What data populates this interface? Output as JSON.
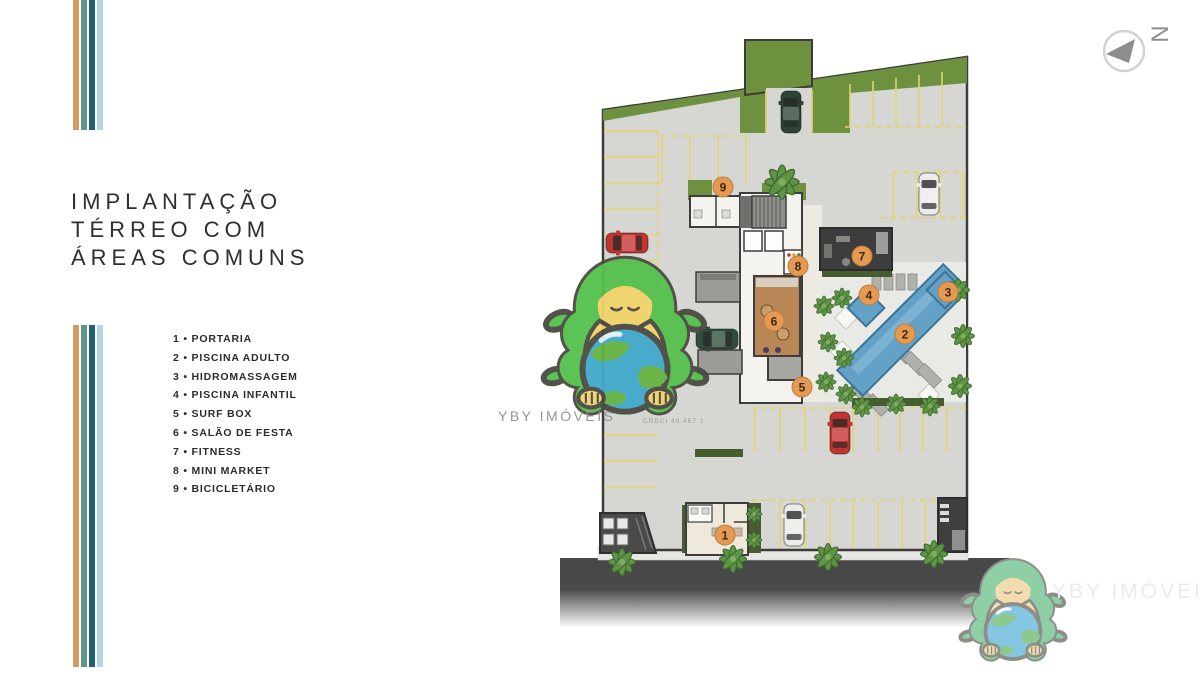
{
  "brand": {
    "stripe_colors": [
      "#d09c60",
      "#61948a",
      "#225f70",
      "#b5d5e5"
    ]
  },
  "title": {
    "line1": "IMPLANTAÇÃO",
    "line2": "TÉRREO COM",
    "line3": "ÁREAS COMUNS"
  },
  "legend": {
    "items": [
      {
        "number": "1",
        "label": "PORTARIA"
      },
      {
        "number": "2",
        "label": "PISCINA ADULTO"
      },
      {
        "number": "3",
        "label": "HIDROMASSAGEM"
      },
      {
        "number": "4",
        "label": "PISCINA INFANTIL"
      },
      {
        "number": "5",
        "label": "SURF BOX"
      },
      {
        "number": "6",
        "label": "SALÃO DE FESTA"
      },
      {
        "number": "7",
        "label": "FITNESS"
      },
      {
        "number": "8",
        "label": "MINI MARKET"
      },
      {
        "number": "9",
        "label": "BICICLETÁRIO"
      }
    ]
  },
  "plan": {
    "marker_color": "#e49a52",
    "markers": [
      {
        "number": "1",
        "label": "PORTARIA",
        "x": 725,
        "y": 535
      },
      {
        "number": "2",
        "label": "PISCINA ADULTO",
        "x": 905,
        "y": 334
      },
      {
        "number": "3",
        "label": "HIDROMASSAGEM",
        "x": 948,
        "y": 292
      },
      {
        "number": "4",
        "label": "PISCINA INFANTIL",
        "x": 869,
        "y": 295
      },
      {
        "number": "5",
        "label": "SURF BOX",
        "x": 802,
        "y": 387
      },
      {
        "number": "6",
        "label": "SALÃO DE FESTA",
        "x": 774,
        "y": 321
      },
      {
        "number": "7",
        "label": "FITNESS",
        "x": 862,
        "y": 256
      },
      {
        "number": "8",
        "label": "MINI MARKET",
        "x": 798,
        "y": 266
      },
      {
        "number": "9",
        "label": "BICICLETÁRIO",
        "x": 723,
        "y": 187
      }
    ],
    "creci_text": "CRECI 40.457 J",
    "north_label": "N",
    "watermark_center": {
      "text": "YBY IMÓVEIS"
    },
    "watermark_corner": {
      "text": "YBY IMÓVEIS"
    }
  }
}
